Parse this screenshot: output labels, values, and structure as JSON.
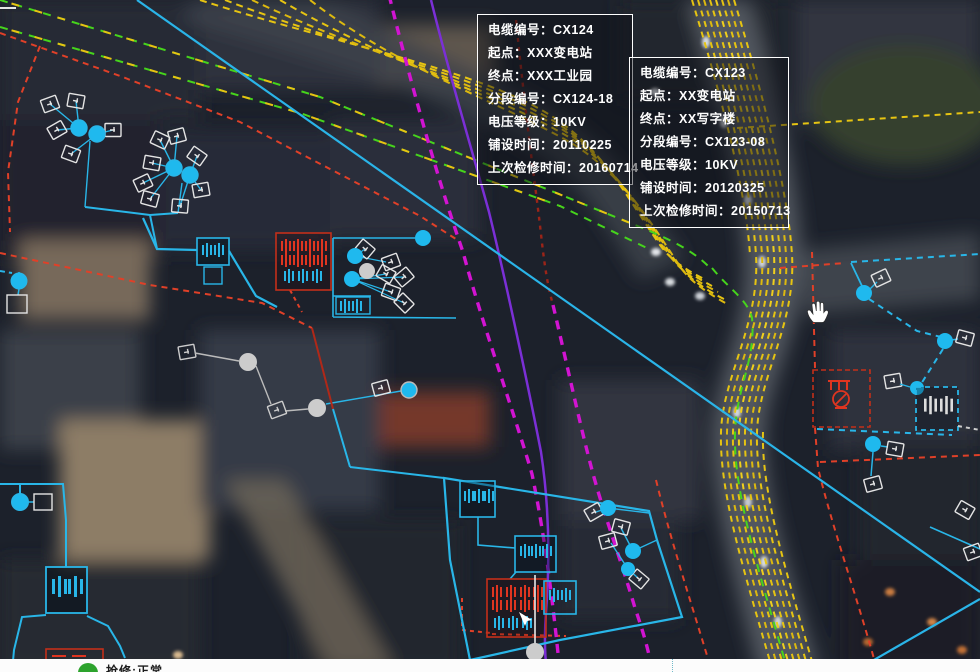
{
  "app": {
    "type": "power-cable-gis-satellite-map"
  },
  "palette": {
    "cable_yellow": "#e6c412",
    "cable_green": "#46d41c",
    "cable_magenta": "#d214d2",
    "cable_purple": "#7b2fd6",
    "cable_cyan": "#29b6e8",
    "cable_red": "#e04028",
    "equipment_white": "#e4e4e4",
    "node_cyan": "#1fb9ee",
    "node_gray": "#cccccc"
  },
  "info_windows": [
    {
      "id": "CX124",
      "rows": [
        "电缆编号：CX124",
        "起点：XXX变电站",
        "终点：XXX工业园",
        "分段编号：CX124-18",
        "电压等级：10KV",
        "铺设时间：20110225",
        "上次检修时间：20160714"
      ]
    },
    {
      "id": "CX123",
      "rows": [
        "电缆编号：CX123",
        "起点：XX变电站",
        "终点：XX写字楼",
        "分段编号：CX123-08",
        "电压等级：10KV",
        "铺设时间：20120325",
        "上次检修时间：20150713"
      ]
    }
  ],
  "legend": {
    "status_color": "#2da32d",
    "label": "抢修:正常"
  },
  "cursor": {
    "icon": "hand-grab-icon"
  }
}
